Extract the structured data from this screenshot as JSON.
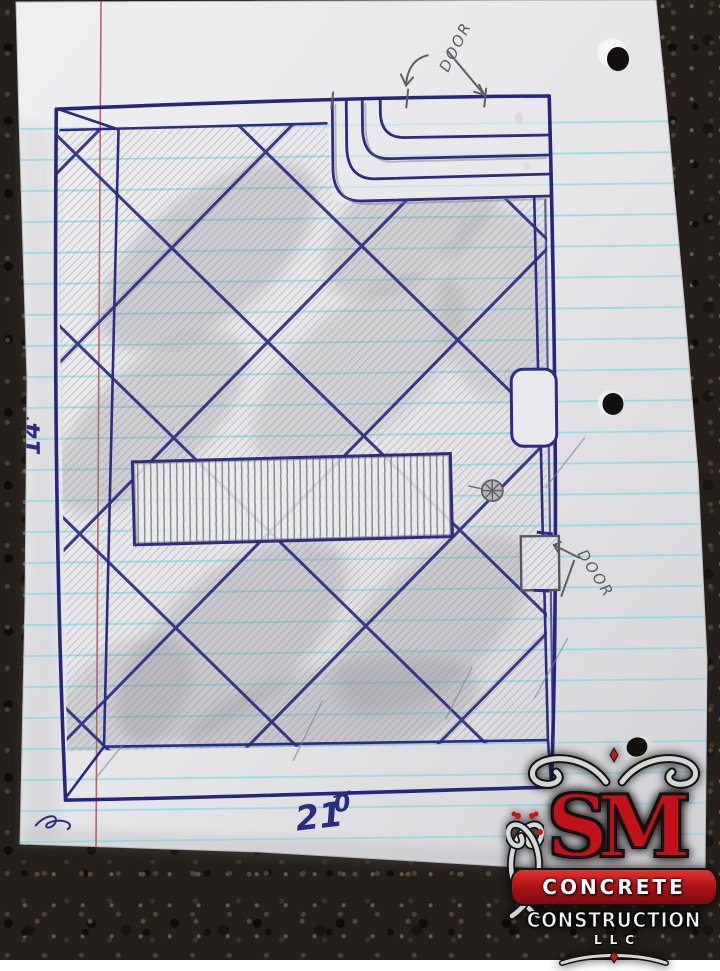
{
  "sketch": {
    "annotations": {
      "door_top": "DOOR",
      "door_right": "DOOR",
      "dim_left": "14'",
      "dim_bottom_main": "21",
      "dim_bottom_sup": "0"
    },
    "symbols": {
      "floor_drain": "floor-drain-icon"
    }
  },
  "logo": {
    "monogram": "SM",
    "line1": "CONCRETE",
    "line2": "CONSTRUCTION",
    "line3": "LLC"
  },
  "colors": {
    "pen_blue": "#2c2c82",
    "pencil_gray": "#6e6e74",
    "ruled_cyan": "#86d7e4",
    "margin_red": "#b34a4e",
    "paper_white": "#e9e9ec",
    "gravel_dark": "#241f1a",
    "logo_red": "#b5181e",
    "logo_silver": "#d6d6d6"
  }
}
